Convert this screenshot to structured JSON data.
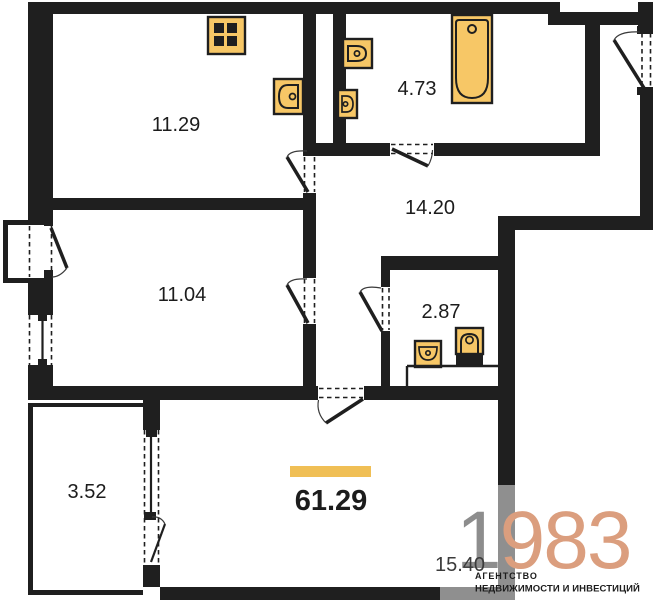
{
  "plan": {
    "title": "apartment-floor-plan",
    "total_area": "61.29",
    "rooms": [
      {
        "name": "kitchen",
        "area": "11.29"
      },
      {
        "name": "bathroom",
        "area": "4.73"
      },
      {
        "name": "hallway",
        "area": "14.20"
      },
      {
        "name": "bedroom",
        "area": "11.04"
      },
      {
        "name": "wc",
        "area": "2.87"
      },
      {
        "name": "balcony",
        "area": "3.52"
      },
      {
        "name": "living-room",
        "area": "15.40"
      }
    ],
    "fixtures": [
      "stove-icon",
      "kitchen-sink-icon",
      "toilet-icon",
      "washbasin-icon",
      "bathtub-icon",
      "wc-sink-icon",
      "wc-toilet-icon"
    ]
  },
  "watermark": {
    "number_gray": "1",
    "number_accent": "983",
    "caption_line1": "АГЕНТСТВО",
    "caption_line2": "НЕДВИЖИМОСТИ И ИНВЕСТИЦИЙ"
  },
  "colors": {
    "wall": "#1f1f1f",
    "fixture_fill": "#f7c766",
    "accent_bar": "#f0bf55",
    "watermark_gray": "#8d8d8d",
    "watermark_accent": "#db9e7e"
  }
}
